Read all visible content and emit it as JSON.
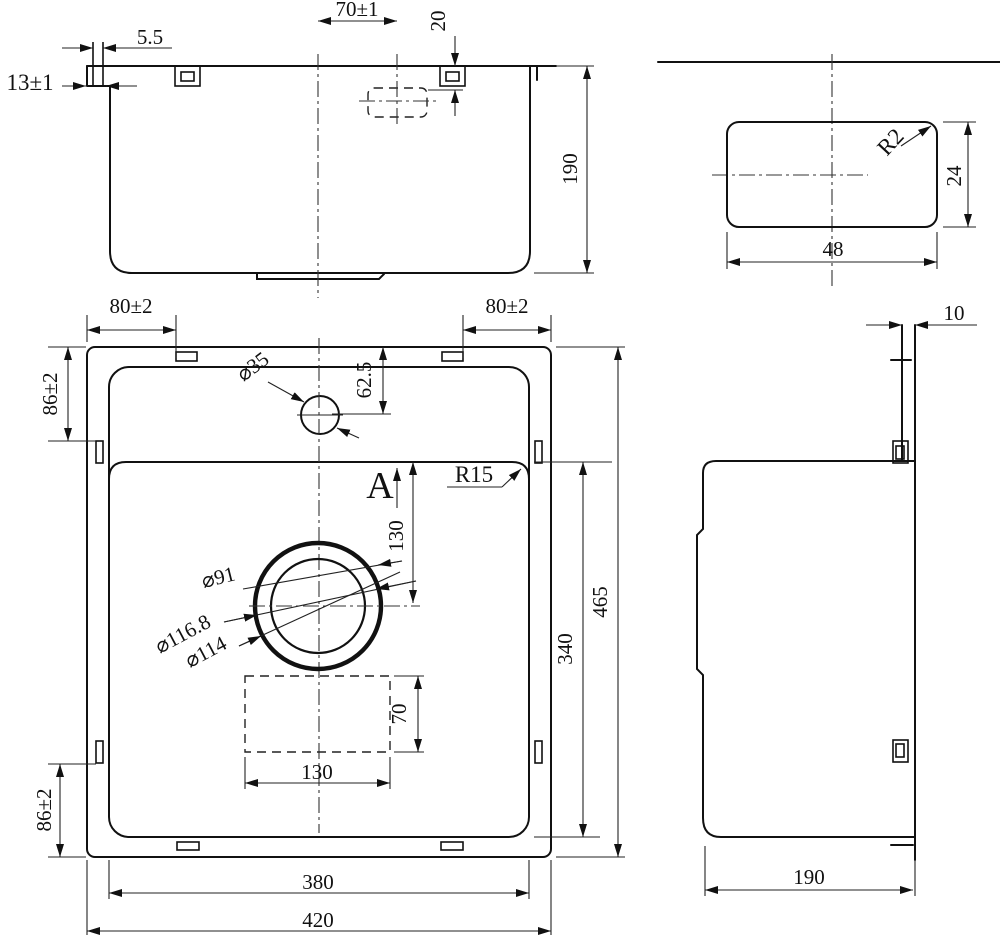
{
  "drawing": {
    "front_view": {
      "dim_rim_lip_width": "5.5",
      "dim_rim_height": "13±1",
      "dim_overflow_offset": "70±1",
      "dim_overflow_depth": "20",
      "dim_bowl_depth": "190"
    },
    "detail_view": {
      "corner_radius": "R2",
      "height": "24",
      "width": "48"
    },
    "top_view": {
      "dim_clip_offset_left": "80±2",
      "dim_clip_offset_right": "80±2",
      "dim_clip_offset_top": "86±2",
      "dim_clip_offset_bottom": "86±2",
      "dim_faucet_offset": "62.5",
      "faucet_hole_dia": "⌀35",
      "view_direction_label": "A",
      "bowl_corner_radius": "R15",
      "dim_drain_from_bowl_top": "130",
      "drain_dia_inner": "⌀91",
      "drain_dia_outer": "⌀116.8",
      "drain_dia_mid": "⌀114",
      "dim_pad_height": "70",
      "dim_pad_width": "130",
      "dim_inner_width": "380",
      "dim_outer_width": "420",
      "dim_outer_height": "465",
      "dim_bowl_height": "340"
    },
    "side_view": {
      "dim_rim_thickness": "10",
      "dim_depth": "190"
    }
  }
}
